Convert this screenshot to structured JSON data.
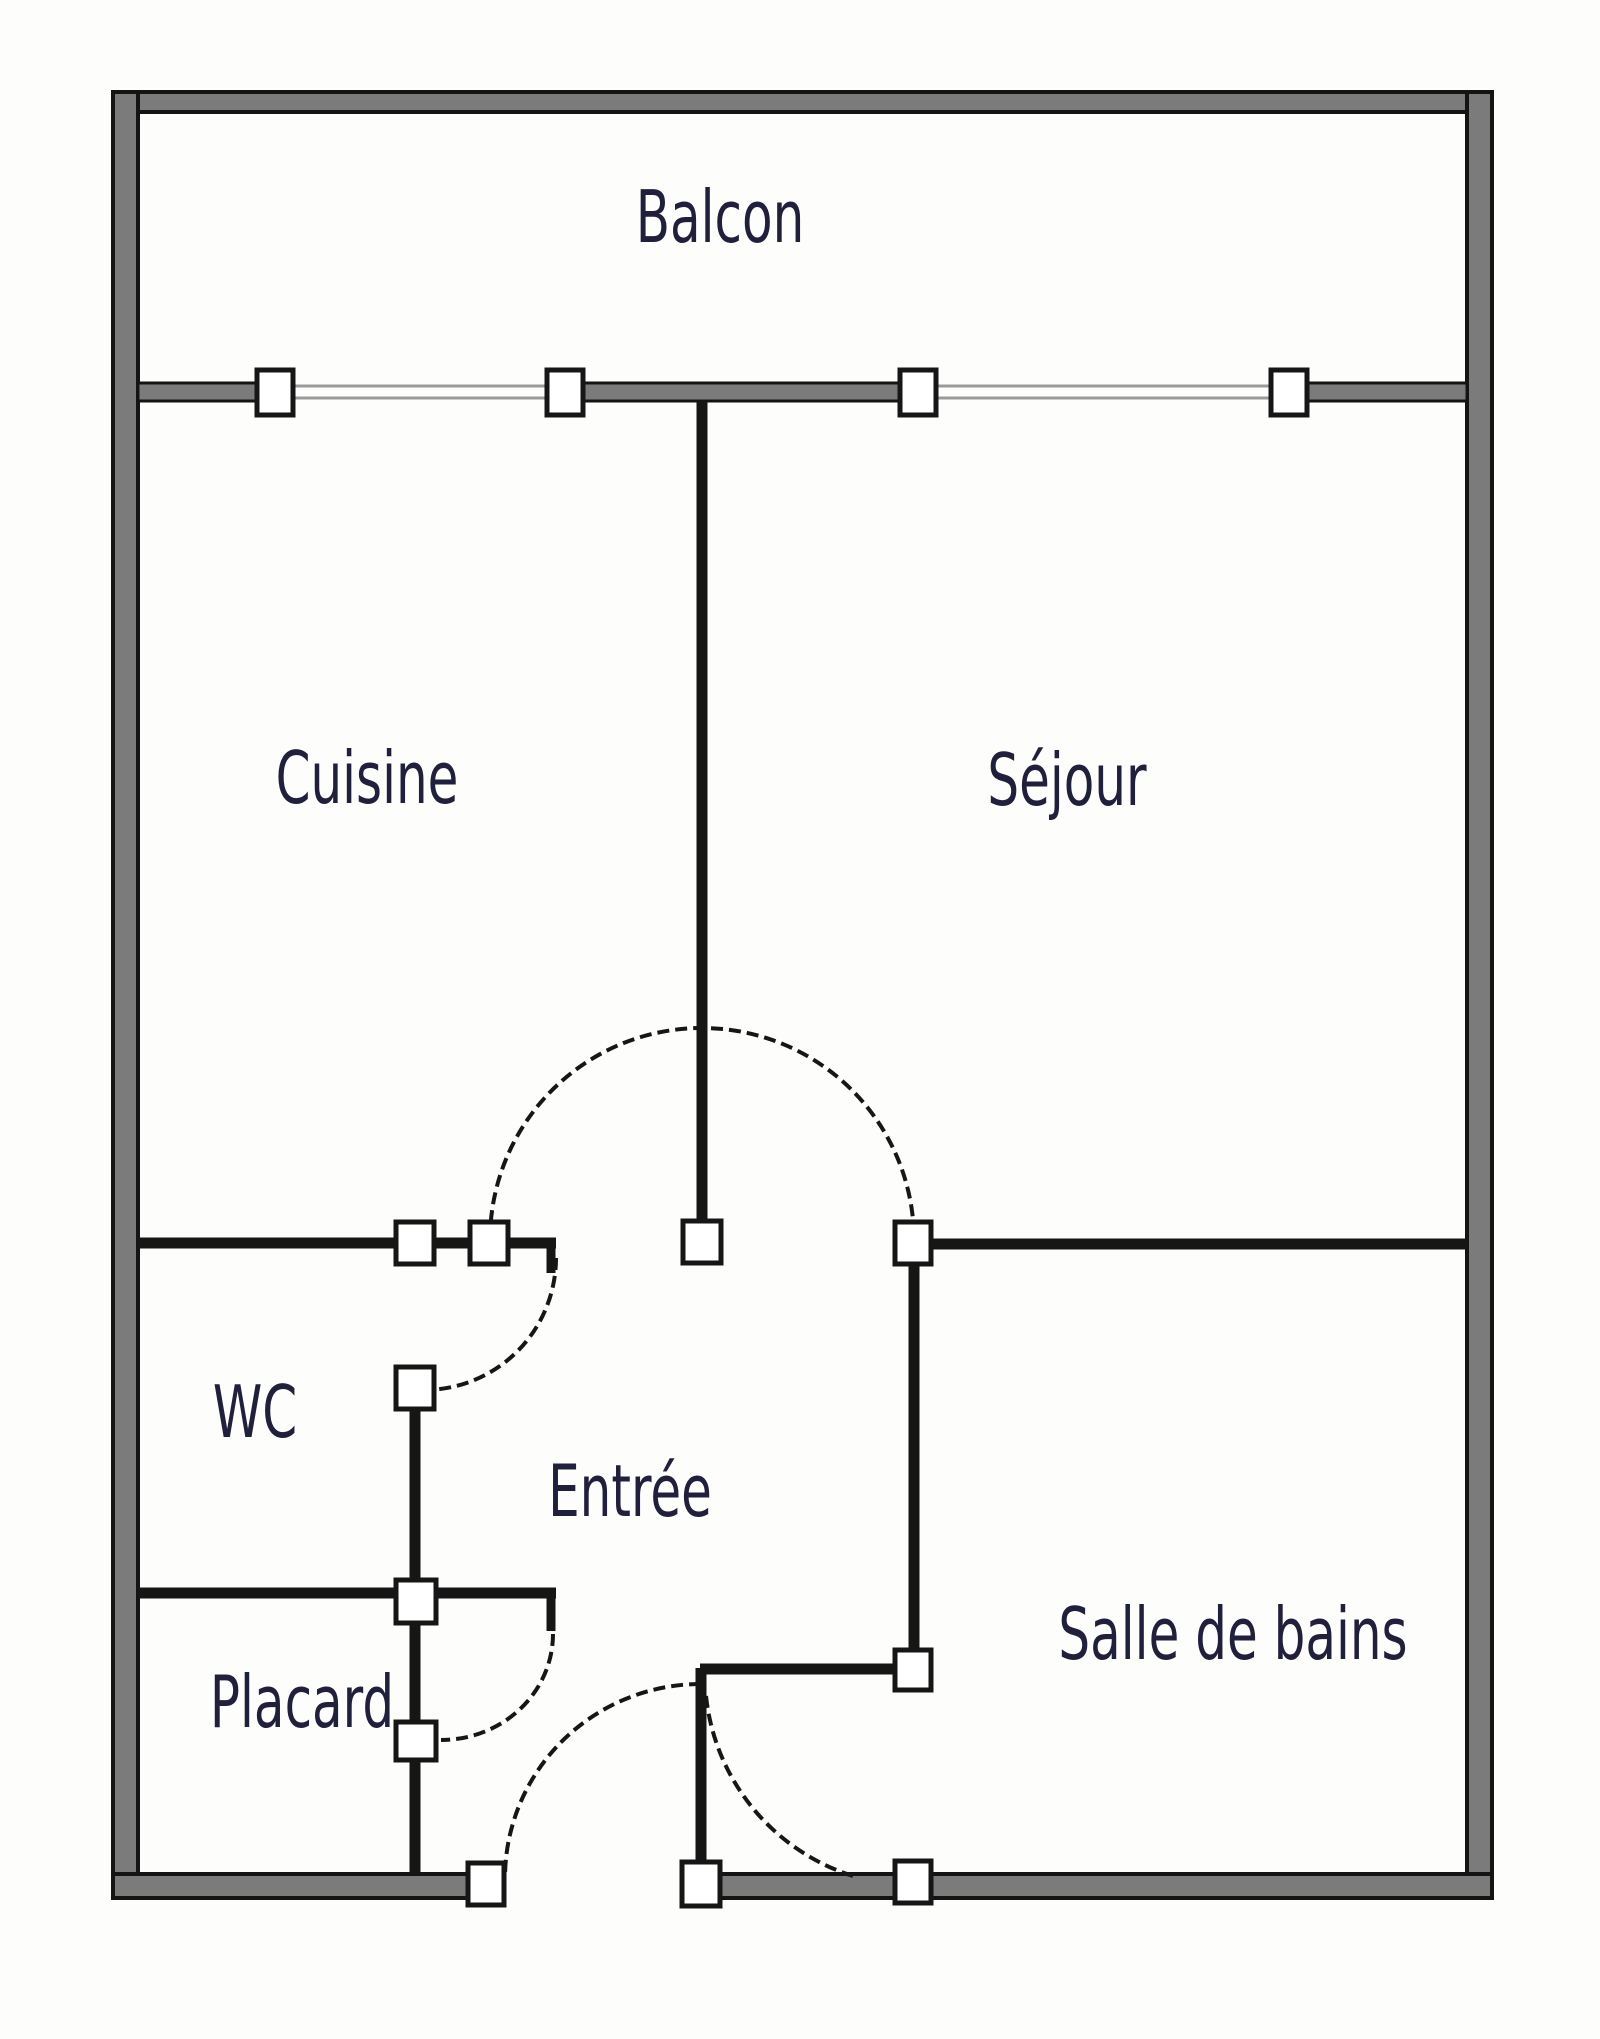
{
  "rooms": [
    {
      "id": "balcon",
      "label": "Balcon"
    },
    {
      "id": "cuisine",
      "label": "Cuisine"
    },
    {
      "id": "sejour",
      "label": "Séjour"
    },
    {
      "id": "wc",
      "label": "WC"
    },
    {
      "id": "entree",
      "label": "Entrée"
    },
    {
      "id": "placard",
      "label": "Placard"
    },
    {
      "id": "salle_de_bains",
      "label": "Salle de bains"
    }
  ],
  "colors": {
    "background": "#fdfdfb",
    "wall_fill": "#7b7b7b",
    "wall_edge": "#141414",
    "interior_wall": "#161616",
    "glazing": "#9a9a9a",
    "square_fill": "#ffffff",
    "label": "#20203c"
  }
}
